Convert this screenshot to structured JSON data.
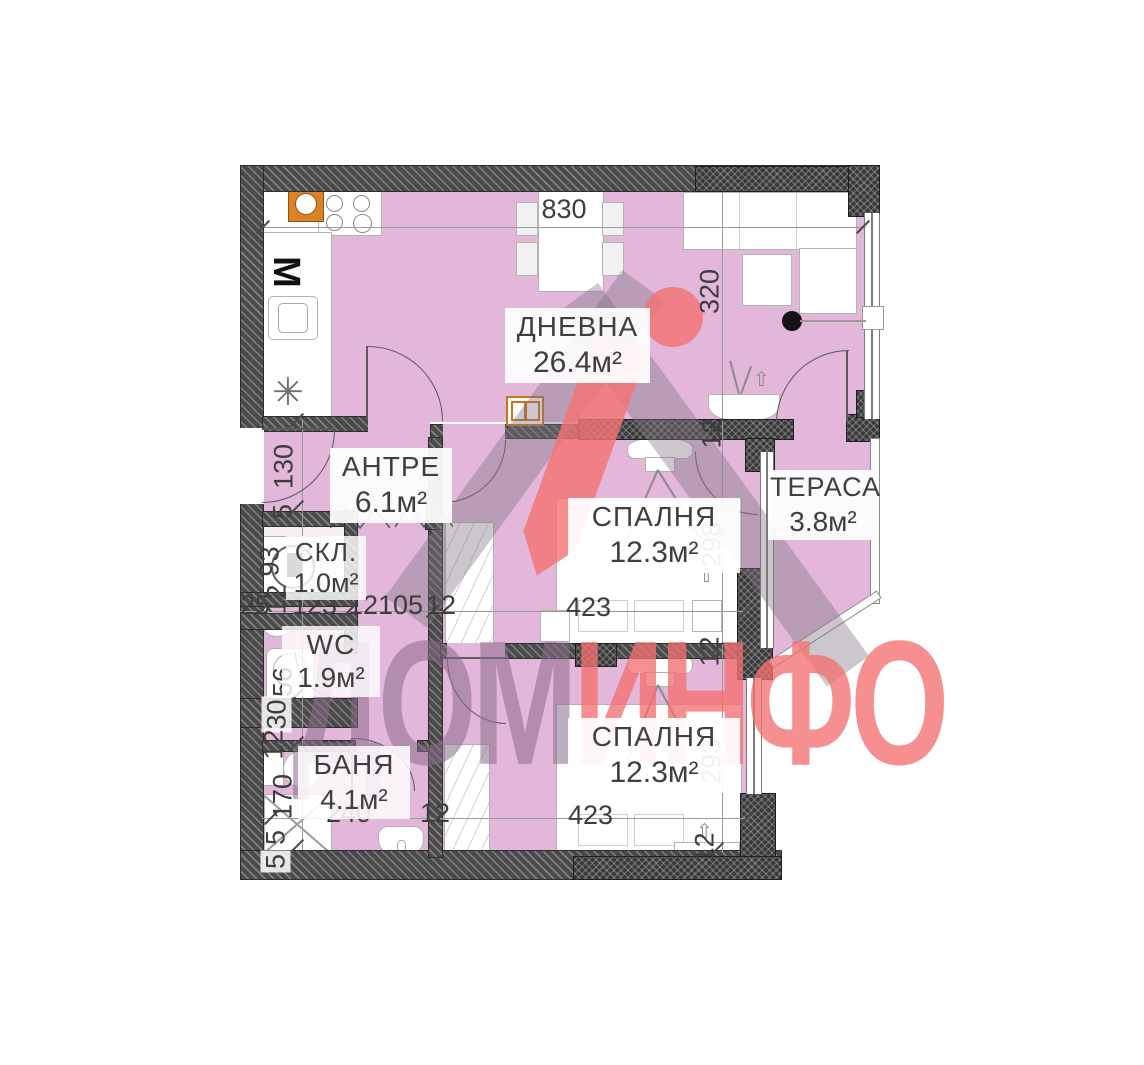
{
  "rooms": {
    "living": {
      "name": "ДНЕВНА",
      "area": "26.4м²"
    },
    "hall": {
      "name": "АНТРЕ",
      "area": "6.1м²"
    },
    "storage": {
      "name": "СКЛ.",
      "area": "1.0м²"
    },
    "wc": {
      "name": "WC",
      "area": "1.9м²"
    },
    "bath": {
      "name": "БАНЯ",
      "area": "4.1м²"
    },
    "bedroom1": {
      "name": "СПАЛНЯ",
      "area": "12.3м²"
    },
    "bedroom2": {
      "name": "СПАЛНЯ",
      "area": "12.3м²"
    },
    "terrace": {
      "name": "ТЕРАСА",
      "area": "3.8м²"
    }
  },
  "dims": {
    "top": "830",
    "living_v": "320",
    "wall_a": "12",
    "bed1_v": "298",
    "mid_wall": "12",
    "bed2_v": "293",
    "bed2_wall": "12",
    "hall_v": "130",
    "hall_wall": "5",
    "storage_v": "93",
    "storage_wall": "12",
    "row": [
      "25",
      "123",
      "12",
      "105",
      "12"
    ],
    "bed1_w": "423",
    "wc_v": "156",
    "shaft": "30",
    "bath_wall": "12",
    "bath_v": "170",
    "bottom_w1": "5",
    "bottom_w2": "5",
    "bath_w": "240",
    "corr_wall": "12",
    "bed2_w": "423"
  },
  "icons": {
    "washing_machine": "М",
    "fridge": "✳",
    "arrow": "⇧"
  },
  "watermark": {
    "text_gray": "ДОМ",
    "text_red": "ИНФО",
    "triangle_color": "#9a8fa0",
    "accent_color": "#f37474"
  }
}
